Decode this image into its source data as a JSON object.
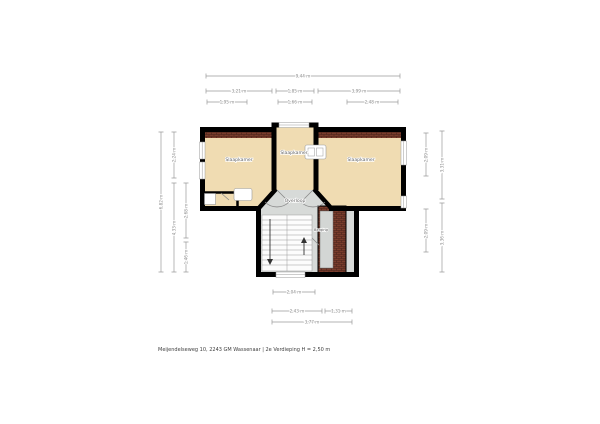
{
  "footer": {
    "caption": "Meijendelseweg 10, 2243 GM Wassenaar | 2e Verdieping H = 2,50 m"
  },
  "floorplan": {
    "rooms": [
      {
        "name": "bedroom-left",
        "label": "Slaapkamer"
      },
      {
        "name": "bedroom-middle",
        "label": "Slaapkamer"
      },
      {
        "name": "bedroom-right",
        "label": "Slaapkamer"
      },
      {
        "name": "landing",
        "label": "Overloop"
      },
      {
        "name": "storage",
        "label": "Berging"
      }
    ],
    "icons": [
      {
        "name": "stairs-down-arrow-icon"
      },
      {
        "name": "stairs-up-arrow-icon"
      },
      {
        "name": "appliance-icon"
      },
      {
        "name": "closet-icon"
      },
      {
        "name": "radiator-icon"
      }
    ],
    "colors": {
      "wall": "#000000",
      "room_fill": "#f0dcb2",
      "landing_fill": "#d7dad8",
      "brick": "#7a3d2c",
      "cupboard_fill": "#d3d6d4",
      "dimension_line": "#9a9a9a",
      "label_text": "#5f5f5f"
    }
  },
  "dimensions": {
    "top": [
      {
        "label": "9,44 m"
      },
      {
        "label": "3,21 m"
      },
      {
        "label": "1,85 m"
      },
      {
        "label": "3,99 m"
      },
      {
        "label": "1,95 m"
      },
      {
        "label": "1,66 m"
      },
      {
        "label": "2,48 m"
      }
    ],
    "left": [
      {
        "label": "6,82 m"
      },
      {
        "label": "2,24 m"
      },
      {
        "label": "4,33 m"
      },
      {
        "label": "2,68 m"
      },
      {
        "label": "1,46 m"
      }
    ],
    "right": [
      {
        "label": "2,09 m"
      },
      {
        "label": "2,09 m"
      },
      {
        "label": "3,31 m"
      },
      {
        "label": "3,36 m"
      }
    ],
    "bottom": [
      {
        "label": "2,04 m"
      },
      {
        "label": "2,43 m"
      },
      {
        "label": "1,31 m"
      },
      {
        "label": "3,77 m"
      }
    ]
  }
}
